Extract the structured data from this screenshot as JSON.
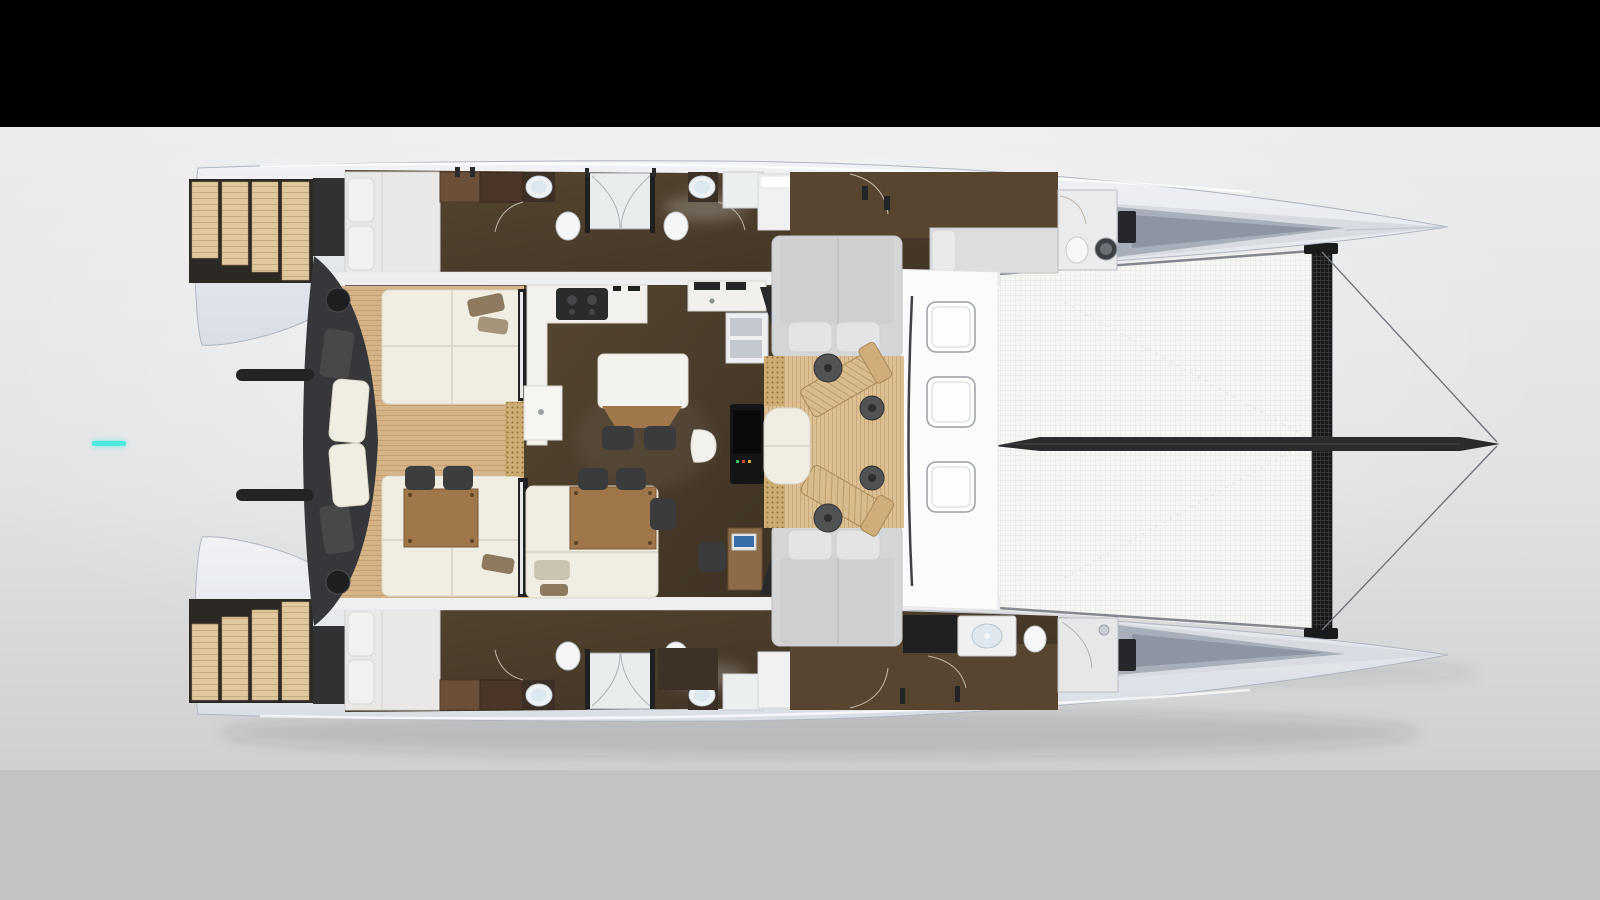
{
  "scene": {
    "title": "Catamaran interior layout - overhead 3D rendered floor plan",
    "view": "top-down, bows pointing right"
  },
  "frame": {
    "top_bar_color": "#010101",
    "bottom_bar_color": "#c4c4c4",
    "photo_bg_top": "#ececee",
    "photo_bg_bottom": "#cfd0d2"
  },
  "indicator": {
    "color": "#4be9df"
  },
  "colors": {
    "barTop": "#010101",
    "barBottom": "#c4c4c4",
    "bgTop": "#ececee",
    "bgBottom": "#cfd0d2",
    "accent": "#4be9df",
    "deck": "#e4e8ed",
    "deckEdge": "#aeb6c2",
    "floorDark": "#46392b",
    "teak": "#d6b488",
    "sofa": "#f0ede3",
    "charcoal": "#35373a",
    "cushionGray": "#d3d5d7",
    "woodTable": "#a0774a",
    "trampoline": "#f6f6f4",
    "beam": "#17181a",
    "bowsprit": "#292b2d",
    "whiteDeck": "#fafbfb"
  },
  "regions": {
    "boat": "catamaran floor plan",
    "portHull": "port hull cabins and bathrooms",
    "starboardHull": "starboard hull cabins and bathrooms",
    "salon": "main salon with galley and dining table",
    "aftCockpit": "aft cockpit with sofas and table",
    "forwardCockpit": "forward cockpit with loungers",
    "foredeck": "foredeck with hatches",
    "trampoline": "bow trampoline net",
    "bowsprit": "bowsprit",
    "sternSteps": "transom swim steps"
  }
}
